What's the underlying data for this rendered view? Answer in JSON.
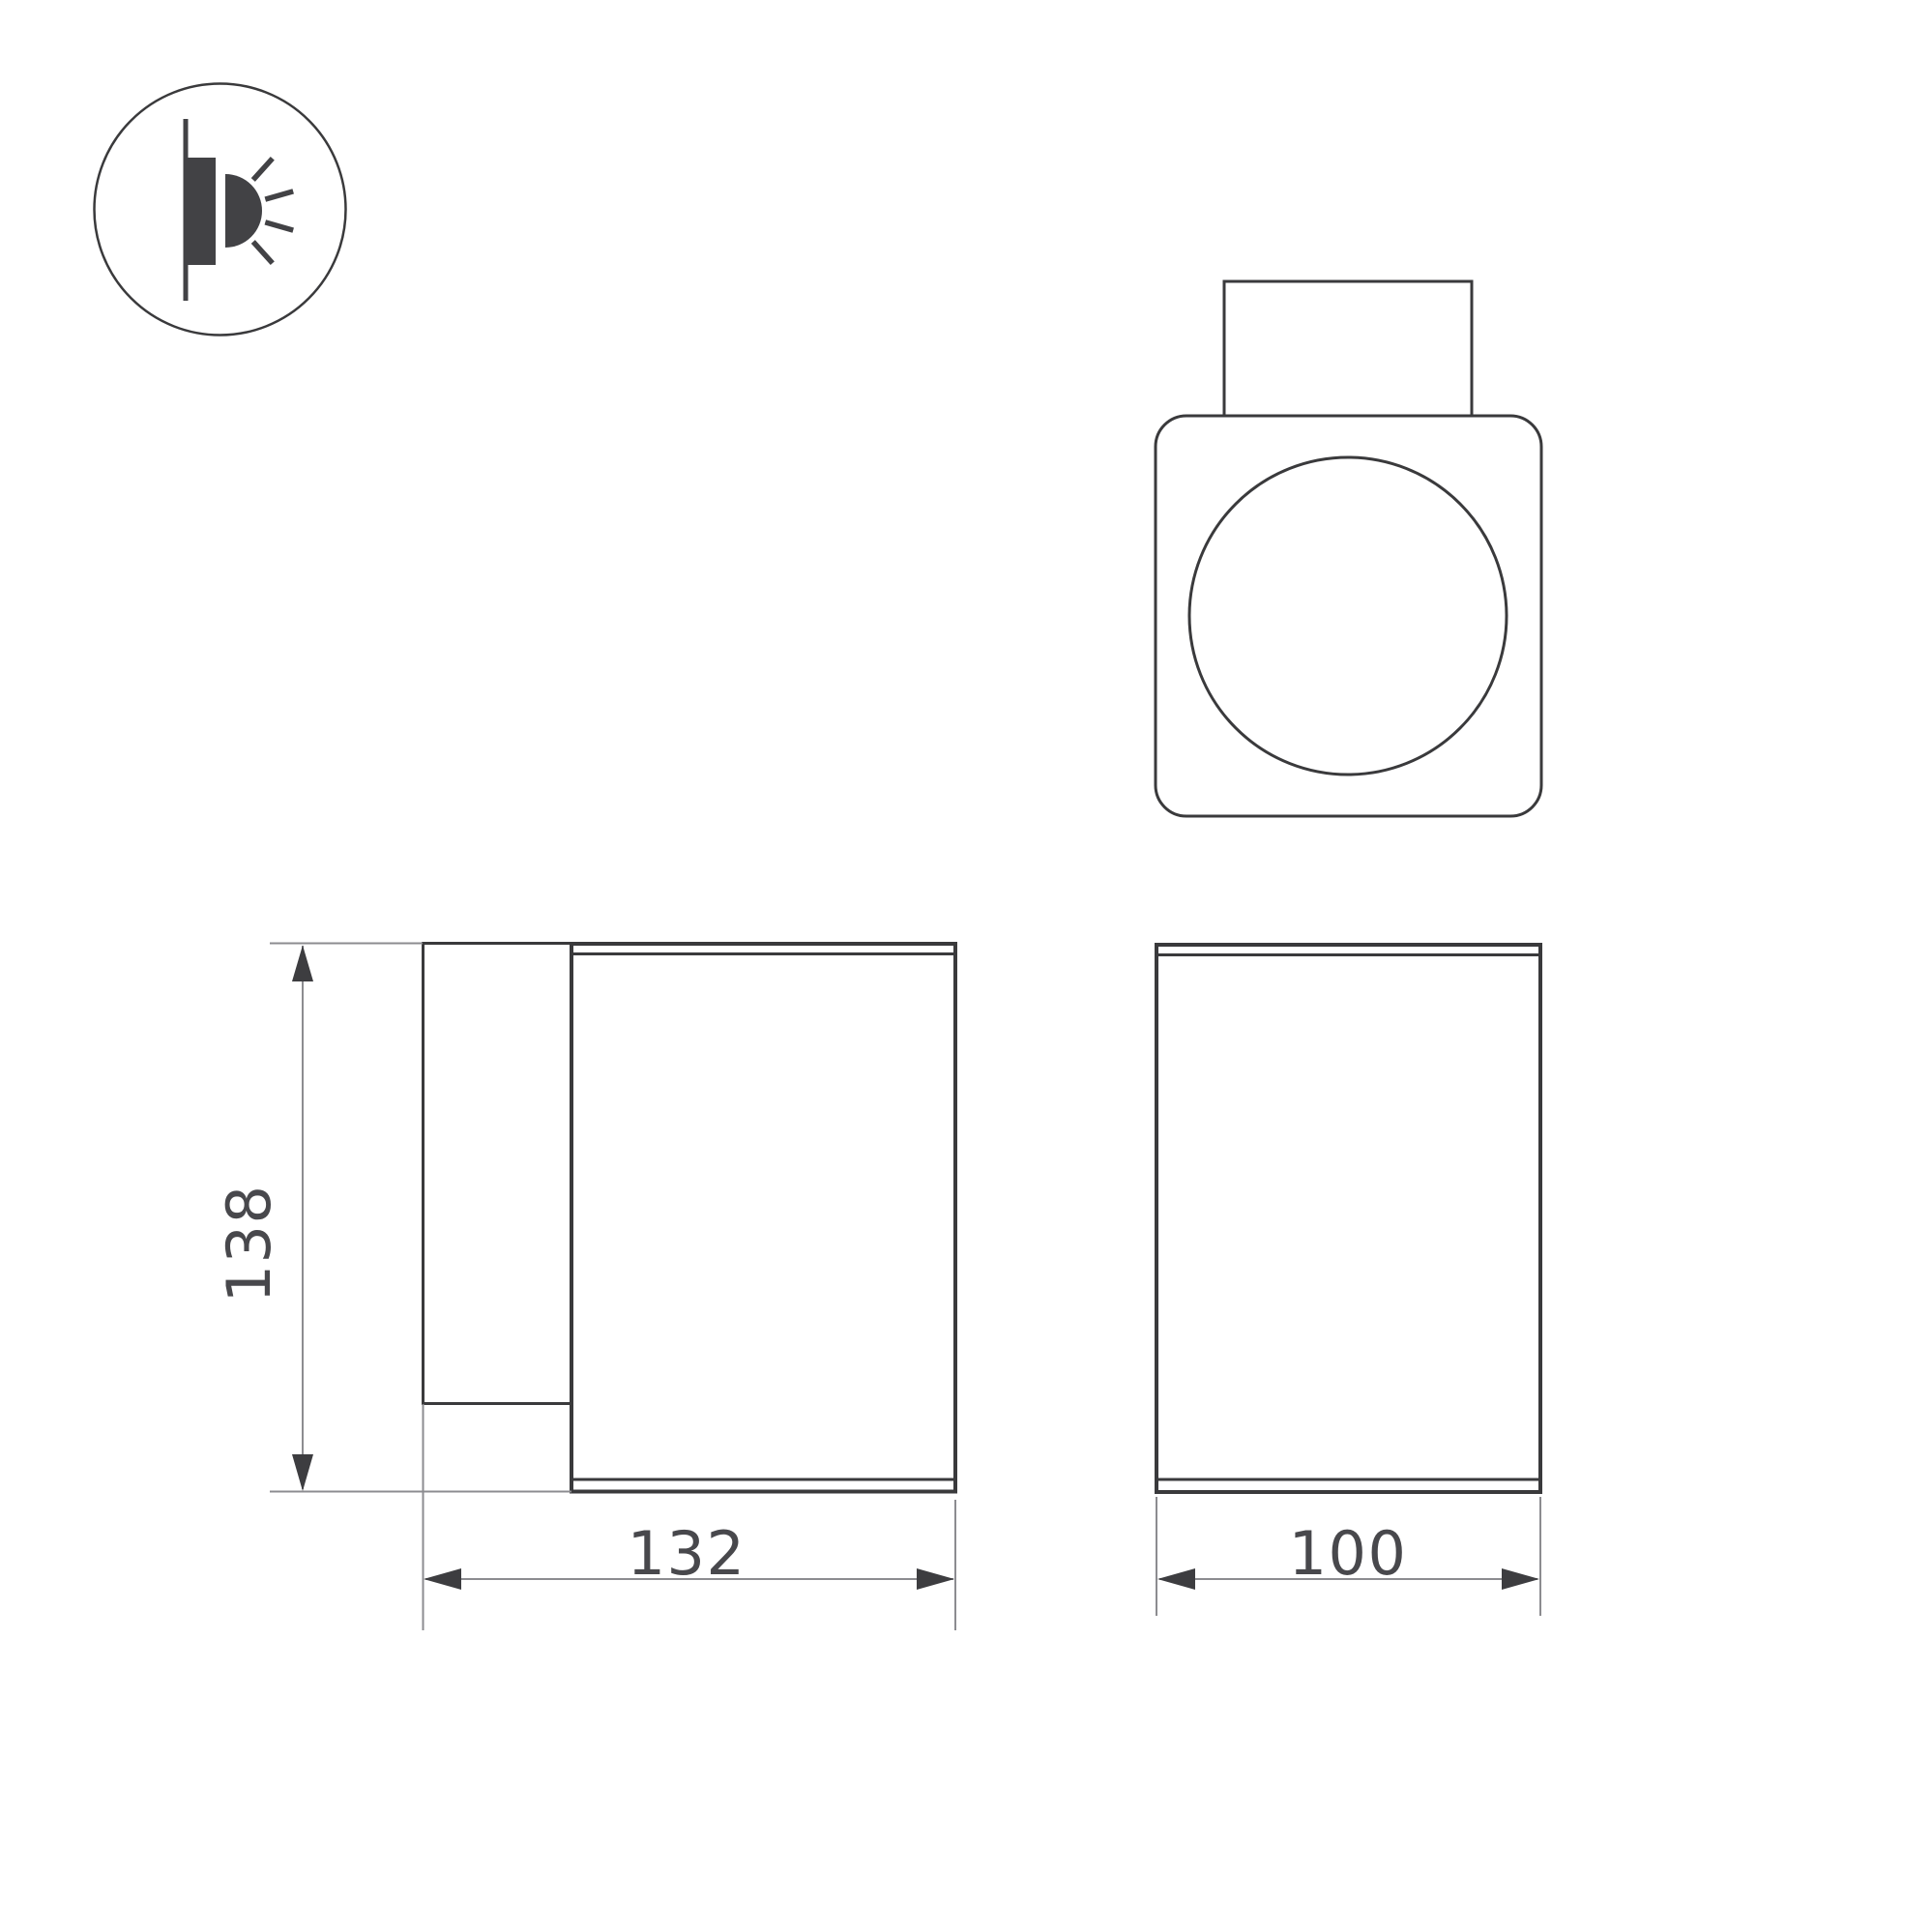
{
  "colors": {
    "bg": "#ffffff",
    "outline": "#3a3a3c",
    "dimline": "#8c8c90",
    "arrow": "#3d3d40",
    "text": "#48484c",
    "icon": "#424245"
  },
  "icons": {
    "wall_light": "wall-mounted-light-side-glow-icon"
  },
  "dimensions": {
    "height_mm": {
      "value": "138"
    },
    "depth_mm": {
      "value": "132"
    },
    "width_mm": {
      "value": "100"
    }
  }
}
